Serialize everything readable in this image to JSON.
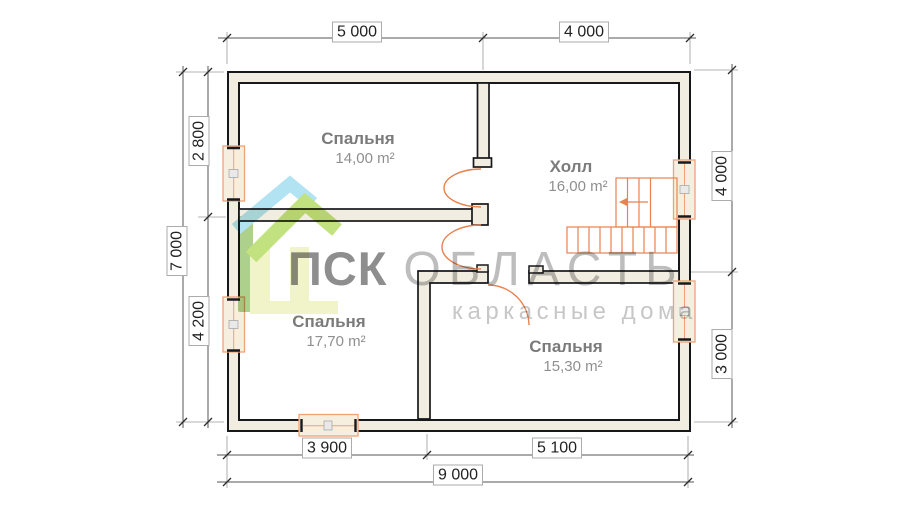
{
  "plan": {
    "rooms": [
      {
        "id": "bedroom-top",
        "name": "Спальня",
        "area": "14,00 m²"
      },
      {
        "id": "hall",
        "name": "Холл",
        "area": "16,00 m²"
      },
      {
        "id": "bedroom-left",
        "name": "Спальня",
        "area": "17,70 m²"
      },
      {
        "id": "bedroom-bottom",
        "name": "Спальня",
        "area": "15,30 m²"
      }
    ],
    "dimensions": {
      "top": [
        "5 000",
        "4 000"
      ],
      "left": {
        "overall": "7 000",
        "segments": [
          "2 800",
          "4 200"
        ]
      },
      "right": [
        "4 000",
        "3 000"
      ],
      "bottom": {
        "segments": [
          "3 900",
          "5 100"
        ],
        "overall": "9 000"
      }
    },
    "watermark": {
      "brand_primary": "ПСК",
      "brand_secondary": "ОБЛАСТЬ",
      "tagline": "каркасные дома"
    },
    "colors": {
      "wall_fill": "#f1ede0",
      "wall_line": "#17181c",
      "joinery_orange": "#e8824f",
      "window_frame": "#efa276",
      "logo_blue": "#a7dff1",
      "logo_green": "#bade6d",
      "logo_pale": "#eff2c2",
      "logo_bar": "#a2ca7c",
      "dimension_text": "#222222",
      "room_text": "#7b7b7b"
    }
  }
}
